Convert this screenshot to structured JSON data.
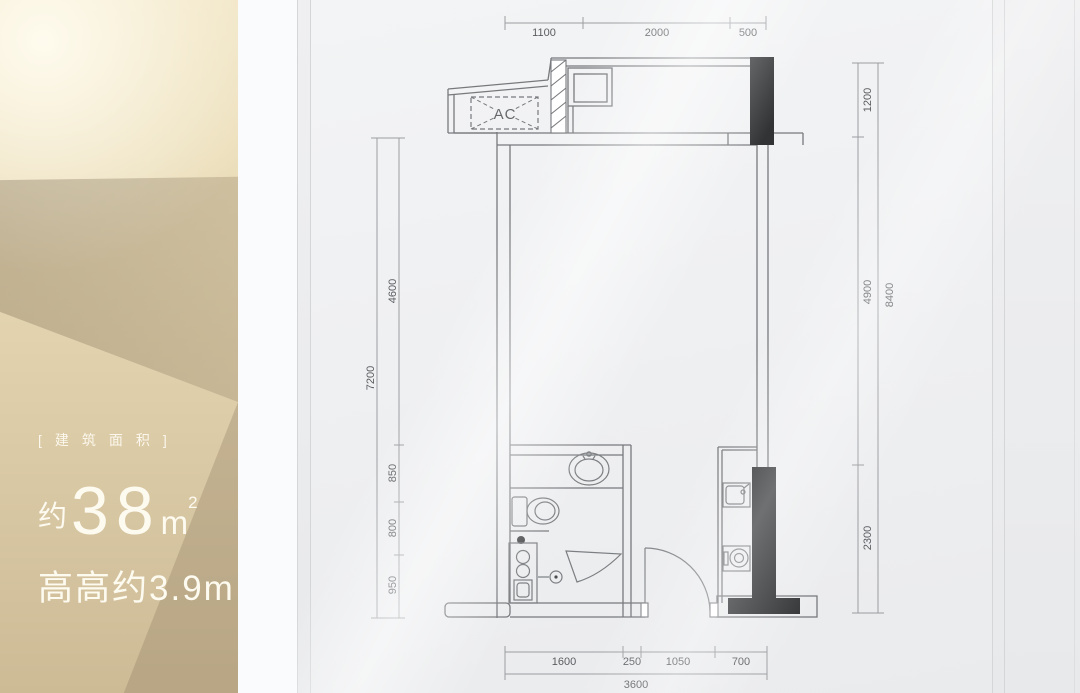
{
  "panel": {
    "area_tag": "[建筑面积]",
    "area_approx": "约",
    "area_value": "38",
    "area_unit": "m",
    "area_exponent": "2",
    "height_note": "高高约3.9m"
  },
  "plan": {
    "ac_label": "AC",
    "dimensions": {
      "top": [
        "1100",
        "2000",
        "500"
      ],
      "left_segments": [
        "4600",
        "850",
        "800",
        "950"
      ],
      "left_total": "7200",
      "right_segments": [
        "1200",
        "4900",
        "2300"
      ],
      "right_total": "8400",
      "bottom_segments": [
        "1600",
        "250",
        "1050",
        "700"
      ],
      "bottom_total": "3600"
    }
  },
  "colors": {
    "wall_line": "#77797c",
    "dim_line": "#9a9da0",
    "column_fill": "#313335",
    "gold_light": "#f1e5c5",
    "gold_dark": "#b9aa8d"
  }
}
